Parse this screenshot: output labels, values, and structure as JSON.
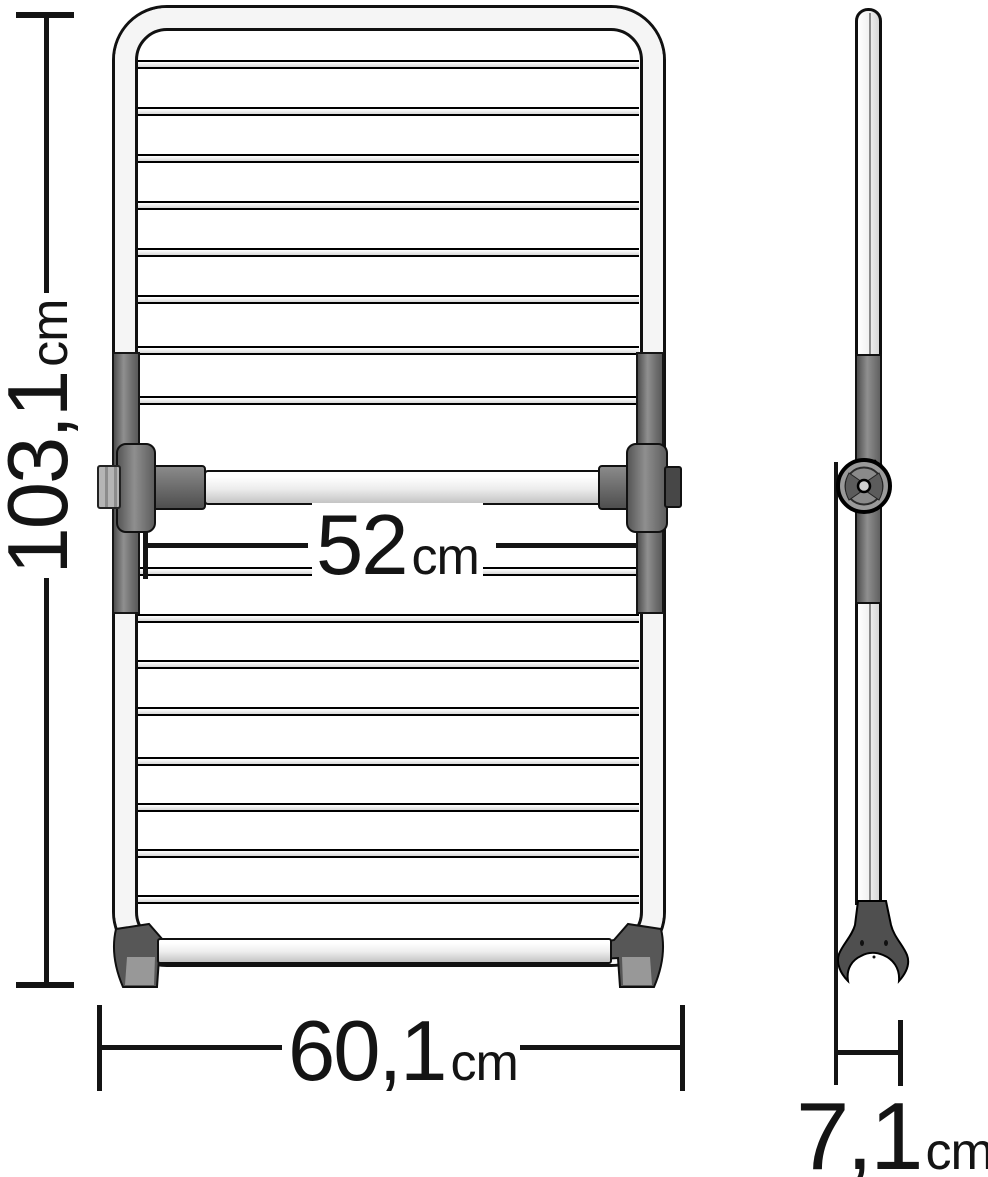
{
  "drawing": {
    "title": "Clothes airer dimension drawing",
    "views": {
      "front": "front view",
      "side": "side view"
    },
    "dimensions": {
      "height": {
        "value": "103,1",
        "unit": "cm"
      },
      "rail_width": {
        "value": "52",
        "unit": "cm"
      },
      "base_width": {
        "value": "60,1",
        "unit": "cm"
      },
      "depth": {
        "value": "7,1",
        "unit": "cm"
      }
    },
    "colors": {
      "outline": "#111111",
      "tube_fill": "#f5f5f5",
      "gray_part": "#7d7d7d",
      "dark_part": "#4f4f4f",
      "background": "#ffffff"
    }
  }
}
